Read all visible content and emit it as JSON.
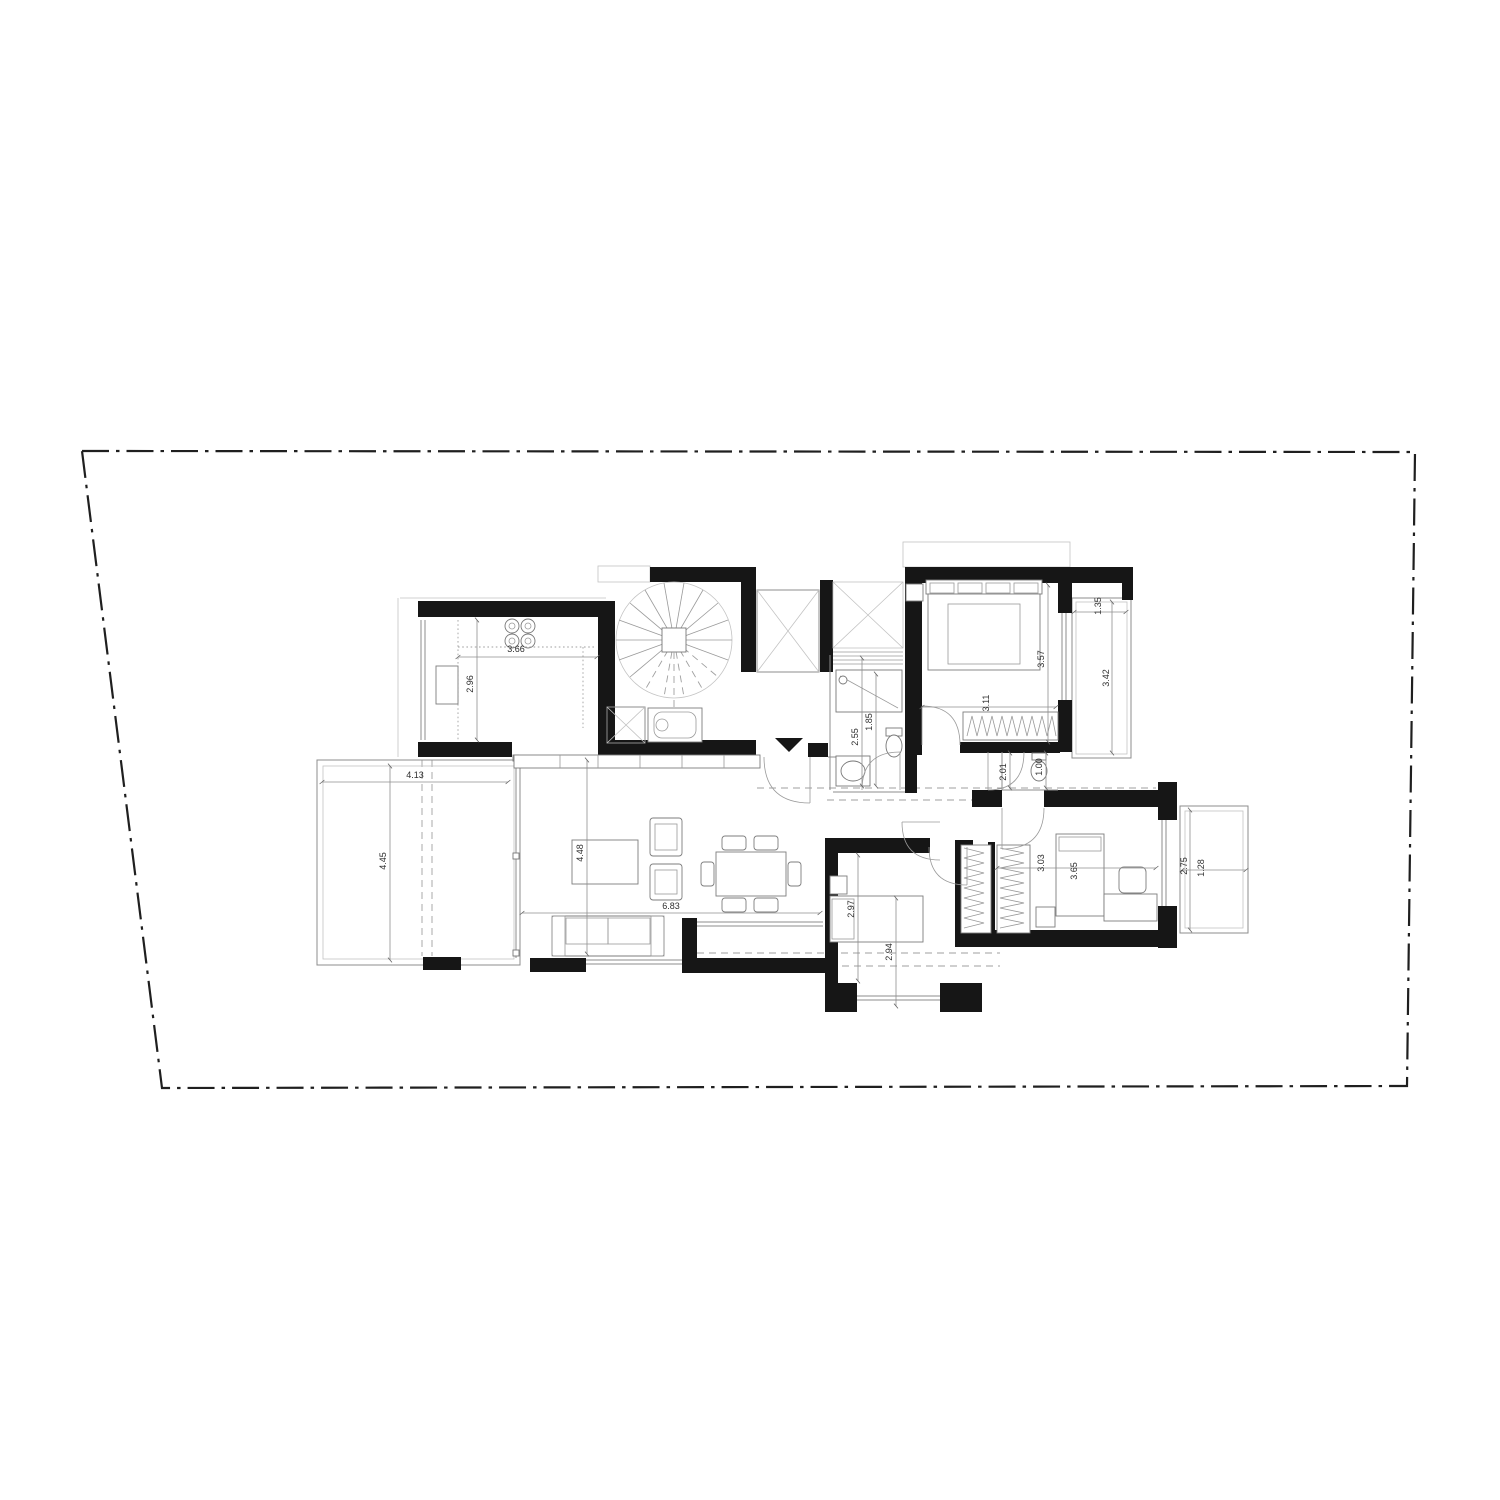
{
  "drawing": {
    "type": "architectural-floor-plan",
    "colors": {
      "wall": "#161616",
      "line": "#8c8c8c",
      "light_line": "#c3c3c3",
      "dimension_text": "#2e2e2e",
      "boundary": "#1f1f1f",
      "background": "#ffffff"
    },
    "dimensions": {
      "kitchen_width": "3.66",
      "kitchen_depth": "2.96",
      "terrace_width": "4.13",
      "terrace_depth": "4.45",
      "living_depth": "4.48",
      "living_width": "6.83",
      "shower_depth": "1.85",
      "bathroom_depth": "2.55",
      "bedroom1_depth": "3.57",
      "bedroom1_width": "3.11",
      "balcony1_width": "1.35",
      "balcony1_depth": "3.42",
      "hall_wc_depth": "2.01",
      "hall_wc_width": "1.00",
      "bedroom2_depth": "2.97",
      "bedroom2_width": "2.94",
      "bedroom3_width": "3.03",
      "bedroom3_bed_length": "3.65",
      "balcony3_depth": "2.75",
      "balcony3_width": "1.28"
    }
  }
}
